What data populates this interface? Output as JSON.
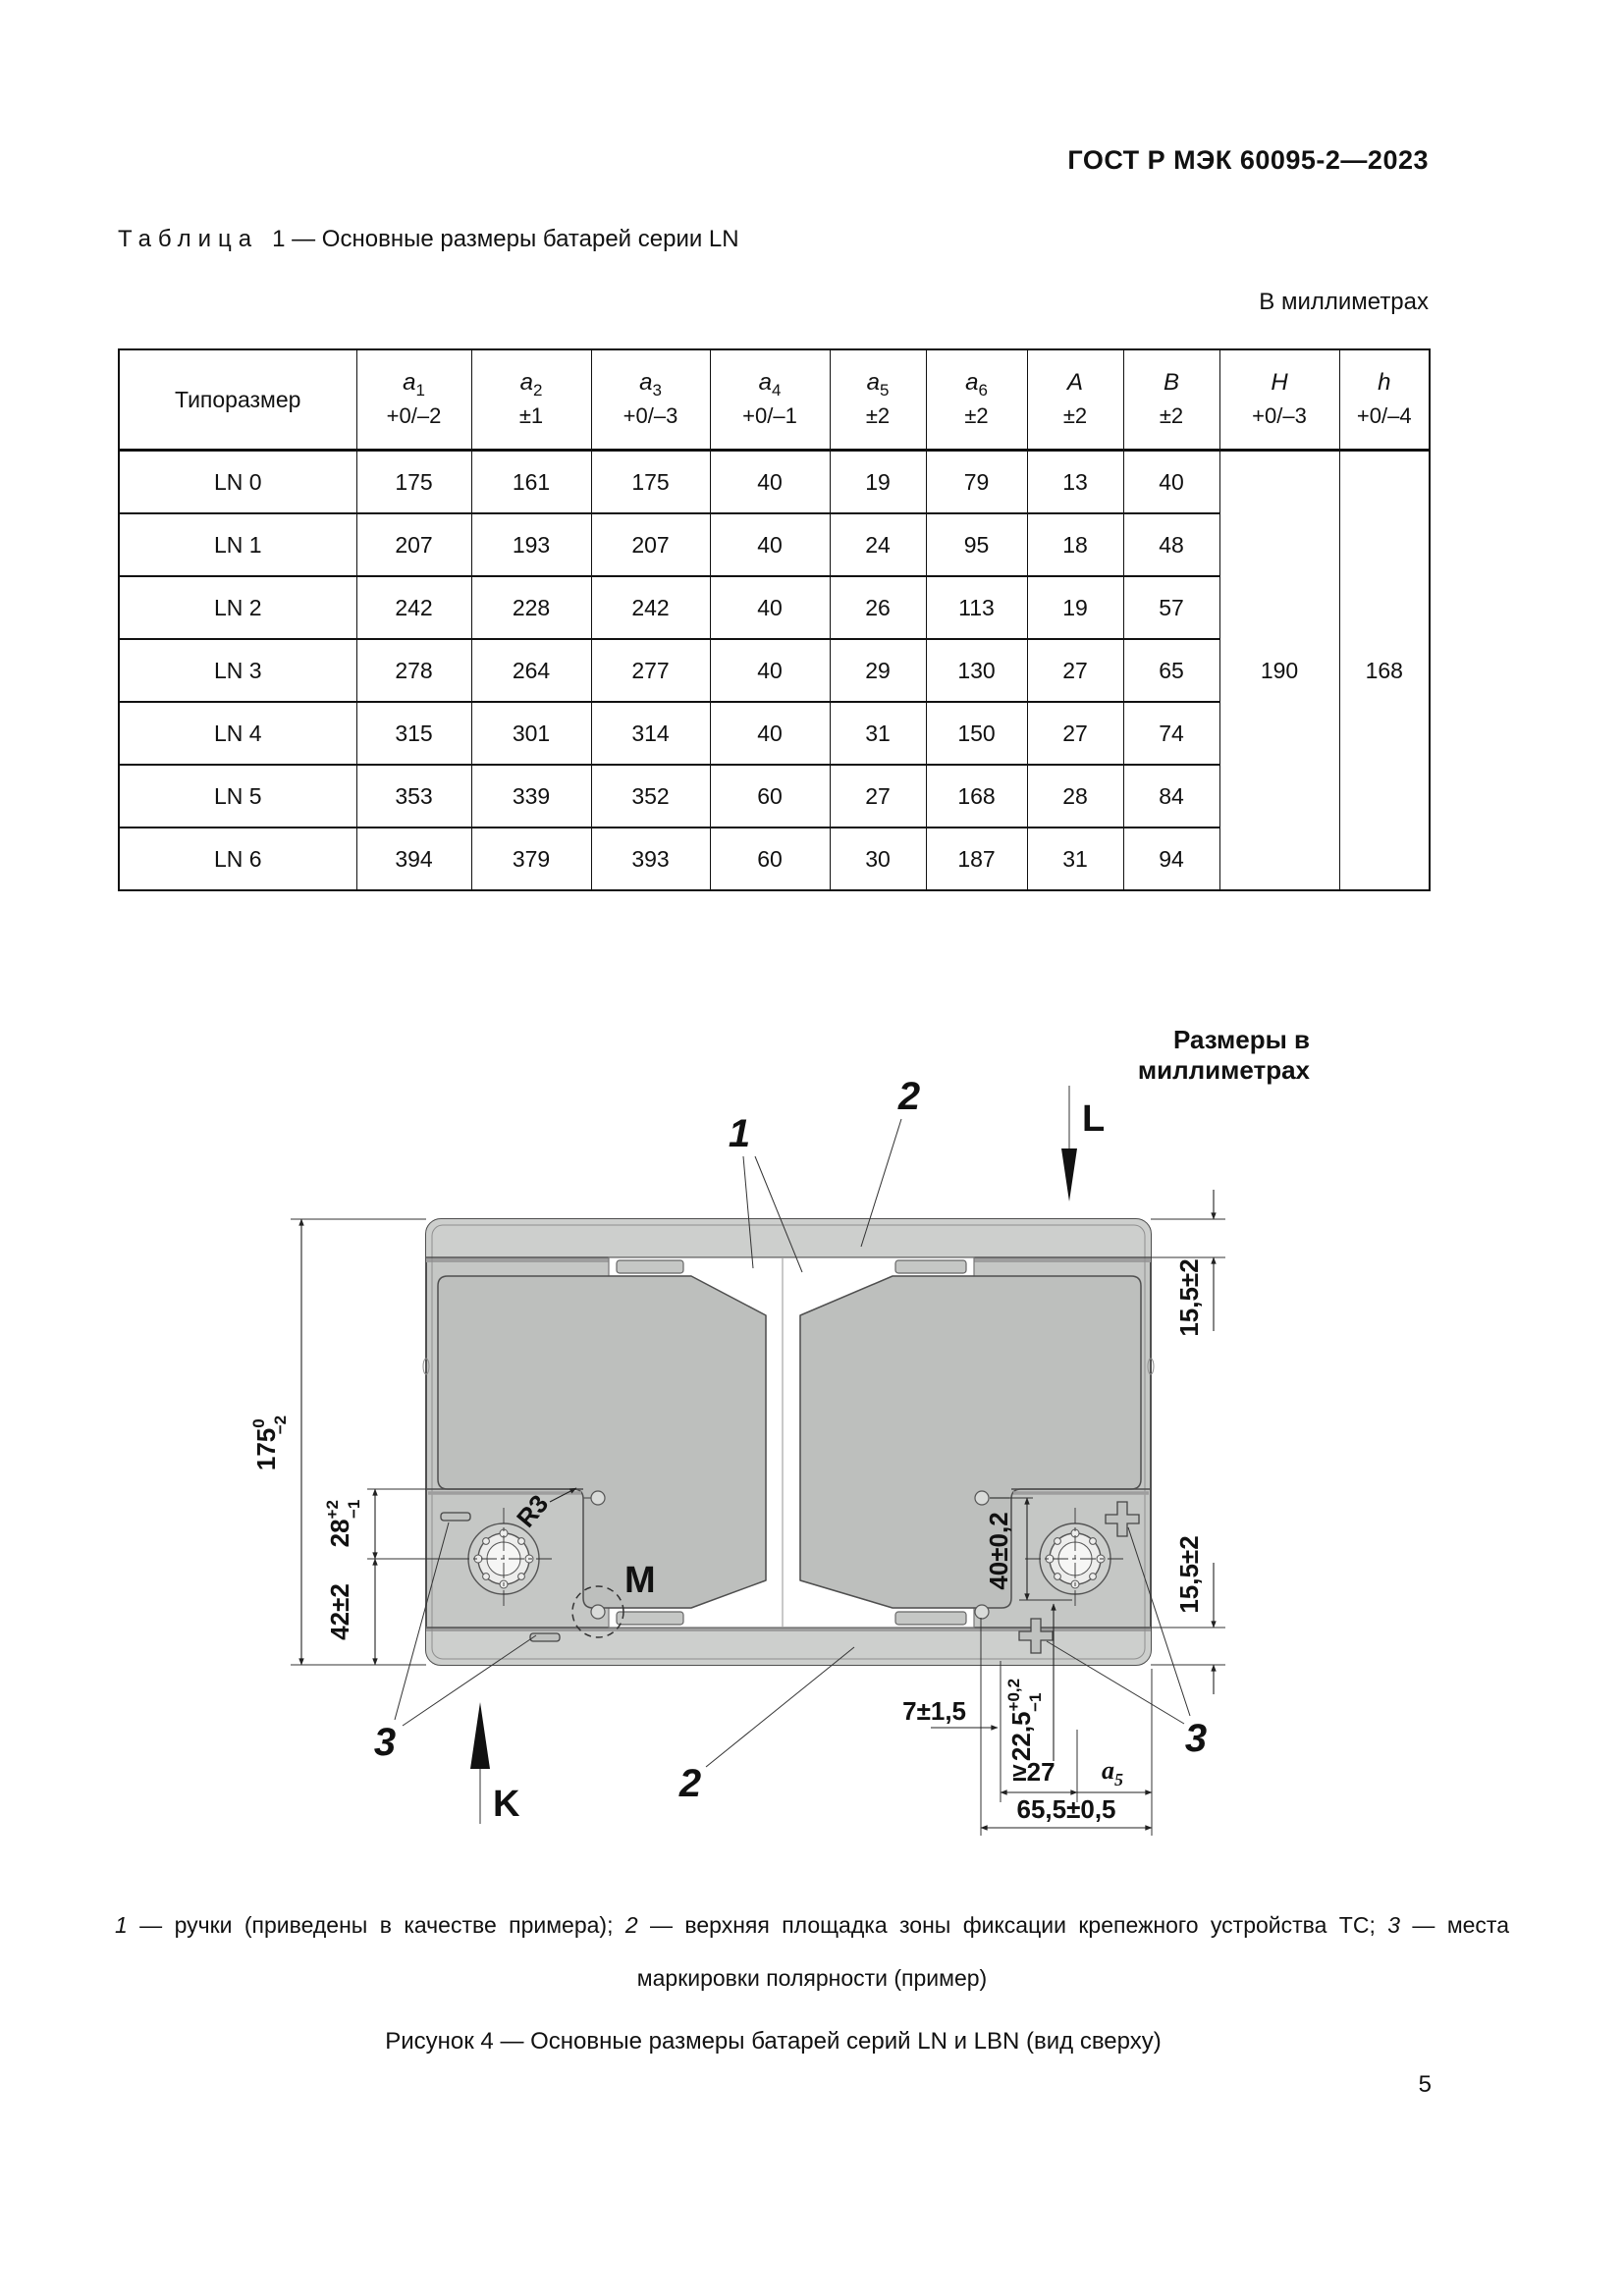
{
  "page": {
    "standard_ref": "ГОСТ Р МЭК 60095-2—2023",
    "page_number": "5"
  },
  "table": {
    "caption_word": "Таблица",
    "caption_num": "1",
    "caption_rest": " — Основные размеры батарей серии LN",
    "units_note": "В миллиметрах",
    "col0_header": "Типоразмер",
    "columns": [
      {
        "var": "a",
        "sub": "1",
        "tol": "+0/–2"
      },
      {
        "var": "a",
        "sub": "2",
        "tol": "±1"
      },
      {
        "var": "a",
        "sub": "3",
        "tol": "+0/–3"
      },
      {
        "var": "a",
        "sub": "4",
        "tol": "+0/–1"
      },
      {
        "var": "a",
        "sub": "5",
        "tol": "±2"
      },
      {
        "var": "a",
        "sub": "6",
        "tol": "±2"
      },
      {
        "var": "A",
        "sub": "",
        "tol": "±2"
      },
      {
        "var": "B",
        "sub": "",
        "tol": "±2"
      },
      {
        "var": "H",
        "sub": "",
        "tol": "+0/–3"
      },
      {
        "var": "h",
        "sub": "",
        "tol": "+0/–4"
      }
    ],
    "rows": [
      {
        "type": "LN 0",
        "values": [
          "175",
          "161",
          "175",
          "40",
          "19",
          "79",
          "13",
          "40"
        ]
      },
      {
        "type": "LN 1",
        "values": [
          "207",
          "193",
          "207",
          "40",
          "24",
          "95",
          "18",
          "48"
        ]
      },
      {
        "type": "LN 2",
        "values": [
          "242",
          "228",
          "242",
          "40",
          "26",
          "113",
          "19",
          "57"
        ]
      },
      {
        "type": "LN 3",
        "values": [
          "278",
          "264",
          "277",
          "40",
          "29",
          "130",
          "27",
          "65"
        ]
      },
      {
        "type": "LN 4",
        "values": [
          "315",
          "301",
          "314",
          "40",
          "31",
          "150",
          "27",
          "74"
        ]
      },
      {
        "type": "LN 5",
        "values": [
          "353",
          "339",
          "352",
          "60",
          "27",
          "168",
          "28",
          "84"
        ]
      },
      {
        "type": "LN 6",
        "values": [
          "394",
          "379",
          "393",
          "60",
          "30",
          "187",
          "31",
          "94"
        ]
      }
    ],
    "merged": {
      "H": "190",
      "h": "168"
    }
  },
  "figure": {
    "units_note": "Размеры в миллиметрах",
    "letters": {
      "L": "L",
      "K": "K",
      "M": "M"
    },
    "radius_label": "R3",
    "callouts": {
      "c1": "1",
      "c2": "2",
      "c3": "3"
    },
    "dims": {
      "height": {
        "val": "175",
        "sup": "0",
        "sub": "−2"
      },
      "d28": {
        "val": "28",
        "sup": "+2",
        "sub": "−1"
      },
      "d42": "42±2",
      "d155_top": "15,5±2",
      "d155_bot": "15,5±2",
      "d40": "40±0,2",
      "d7": "7±1,5",
      "d225": {
        "val": "22,5",
        "sup": "+0,2",
        "sub": "−1"
      },
      "d27": "≥27",
      "a5": {
        "var": "a",
        "sub": "5"
      },
      "d655": "65,5±0,5"
    },
    "legend": {
      "n1": "1",
      "t1": " — ручки (приведены в качестве примера); ",
      "n2": "2",
      "t2": " — верхняя площадка зоны фиксации крепежного устройства ТС; ",
      "n3": "3",
      "t3": " — места"
    },
    "legend_line2": "маркировки полярности (пример)",
    "caption": "Рисунок 4 — Основные размеры батарей серий LN и LBN (вид сверху)"
  }
}
